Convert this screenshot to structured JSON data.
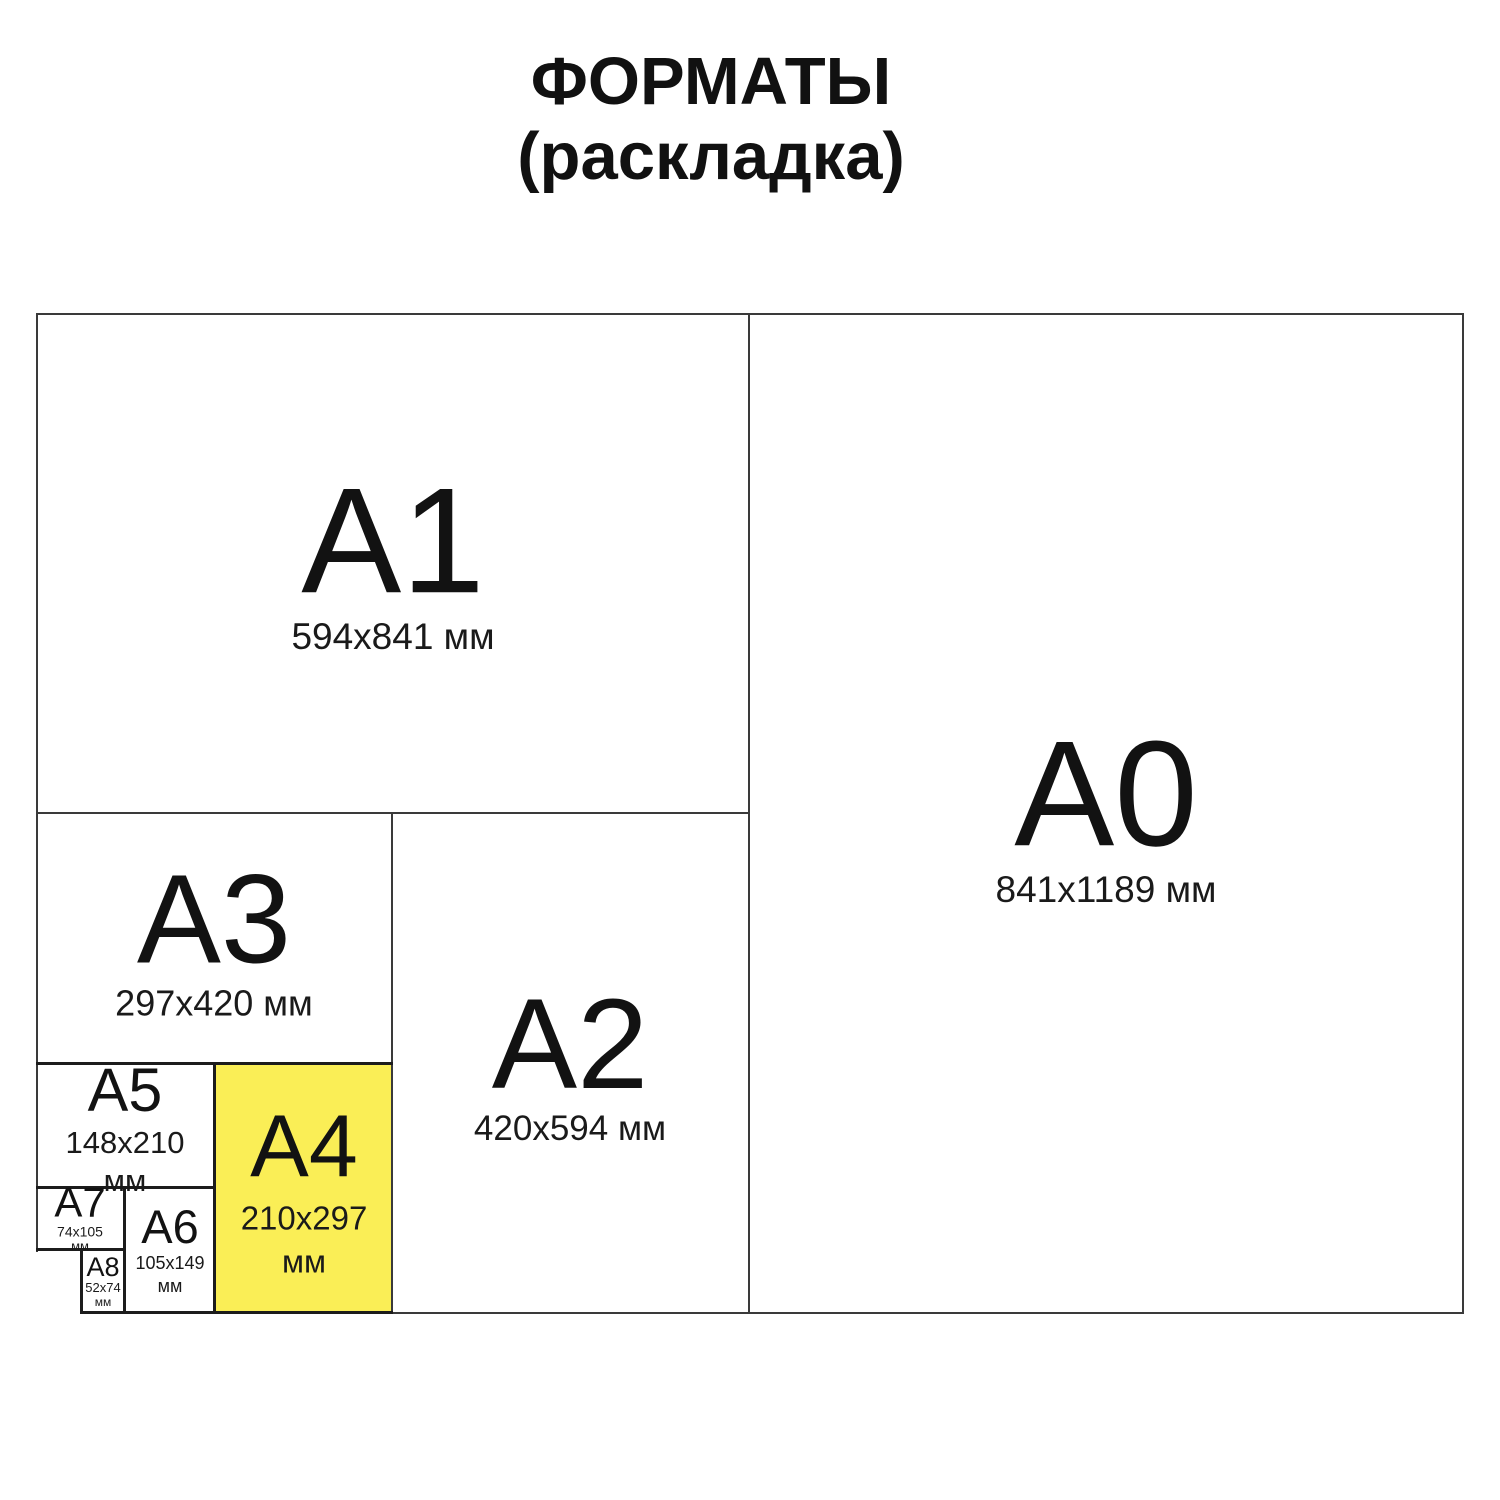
{
  "title": {
    "line1": "ФОРМАТЫ",
    "line2": "(раскладка)"
  },
  "colors": {
    "background": "#ffffff",
    "highlight_yellow": "#FAEE56",
    "line_major": "#3a3a3a",
    "line_minor": "#1c1c1c",
    "text": "#121212"
  },
  "formats": [
    {
      "id": "a1",
      "label": "A1",
      "dimensions": "594x841 мм"
    },
    {
      "id": "a0",
      "label": "A0",
      "dimensions": "841x1189 мм"
    },
    {
      "id": "a3",
      "label": "A3",
      "dimensions": "297x420 мм"
    },
    {
      "id": "a2",
      "label": "A2",
      "dimensions": "420x594 мм"
    },
    {
      "id": "a5",
      "label": "A5",
      "dimensions": "148x210",
      "unit": "мм"
    },
    {
      "id": "a4",
      "label": "A4",
      "dimensions": "210x297",
      "unit": "мм",
      "highlighted": true
    },
    {
      "id": "a7",
      "label": "A7",
      "dimensions": "74x105",
      "unit": "мм"
    },
    {
      "id": "a6",
      "label": "A6",
      "dimensions": "105x149",
      "unit": "мм"
    },
    {
      "id": "a8",
      "label": "A8",
      "dimensions": "52x74",
      "unit": "мм"
    }
  ]
}
